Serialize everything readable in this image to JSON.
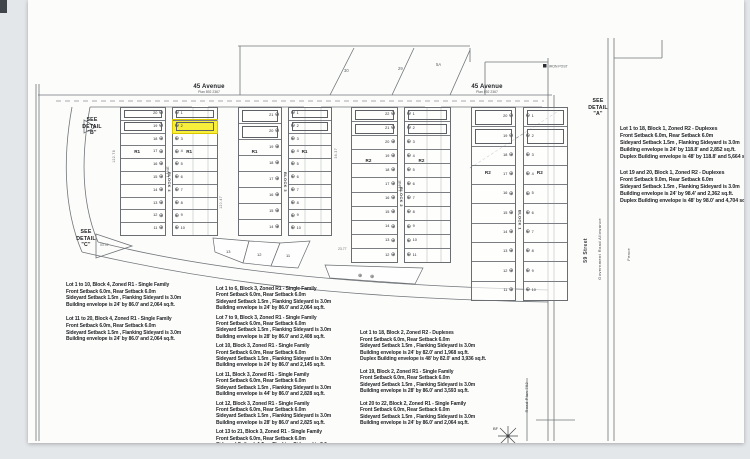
{
  "streets": {
    "avenue_left": {
      "name": "45 Avenue",
      "plan": "Plan 892 2367"
    },
    "avenue_right": {
      "name": "45 Avenue",
      "plan": "Plan 892 2367"
    },
    "street_59": "59 Street",
    "gov_road_allowance": "Government Road Allowance",
    "fence": "Fence",
    "road_plan": "Road Plan 792",
    "lane": "LANE"
  },
  "callouts": {
    "detail_a": "SEE\nDETAIL\n\"A\"",
    "detail_b": "SEE\nDETAIL\n\"B\"",
    "detail_c": "SEE\nDETAIL\n\"C\""
  },
  "markers": {
    "bf": "BF",
    "iron_post": "IRON POST"
  },
  "parcel_numbers": [
    "30",
    "29",
    "5A"
  ],
  "dims": [
    "122.78",
    "120.47",
    "36.37",
    "53.92",
    "23.77"
  ],
  "plat": {
    "marker_glyph": "⊕",
    "highlight_color": "#f7ef3a",
    "angled_lot_numbers": [
      "13",
      "12",
      "11"
    ],
    "groups": [
      {
        "name": "block-4",
        "label": "BLOCK 4",
        "zone": "R1",
        "x": 92,
        "y": 107,
        "w": 98,
        "h": 129,
        "lane_label": true,
        "west": [
          "20",
          "19",
          "18",
          "17",
          "16",
          "15",
          "14",
          "13",
          "12",
          "11"
        ],
        "east": [
          "1",
          "2",
          "3",
          "4",
          "5",
          "6",
          "7",
          "8",
          "9",
          "10"
        ],
        "highlight": {
          "side": "e",
          "index": 1
        }
      },
      {
        "name": "block-3",
        "label": "BLOCK 3",
        "zone": "R1",
        "x": 210,
        "y": 107,
        "w": 94,
        "h": 129,
        "lane_label": false,
        "west": [
          "21",
          "20",
          "19",
          "18",
          "17",
          "16",
          "15",
          "14"
        ],
        "east": [
          "1",
          "2",
          "3",
          "4",
          "5",
          "6",
          "7",
          "8",
          "9",
          "10"
        ]
      },
      {
        "name": "block-2",
        "label": "BLOCK 2",
        "zone": "R2",
        "x": 323,
        "y": 107,
        "w": 100,
        "h": 156,
        "lane_label": true,
        "west": [
          "22",
          "21",
          "20",
          "19",
          "18",
          "17",
          "16",
          "15",
          "14",
          "13",
          "12"
        ],
        "east": [
          "1",
          "2",
          "3",
          "4",
          "5",
          "6",
          "7",
          "8",
          "9",
          "10",
          "11"
        ]
      },
      {
        "name": "block-1",
        "label": "BLOCK 1",
        "zone": "R2",
        "x": 443,
        "y": 107,
        "w": 97,
        "h": 194,
        "lane_label": false,
        "west": [
          "20",
          "19",
          "18",
          "17",
          "16",
          "15",
          "14",
          "13",
          "12",
          "11"
        ],
        "east": [
          "1",
          "2",
          "3",
          "4",
          "5",
          "6",
          "7",
          "8",
          "9",
          "10"
        ]
      }
    ]
  },
  "notes": {
    "columns": [
      {
        "x": 38,
        "y": 282,
        "w": 150,
        "fs": 5,
        "lh": 6.6,
        "gap": 8,
        "blocks": [
          [
            "Lot 1 to 10, Block 4, Zoned R1 - Single Family",
            "Front Setback 6.0m, Rear Setback 6.0m",
            "Sideyard Setback 1.5m , Flanking Sideyard is 3.0m",
            "Building envelope is 24' by 86.0' and 2,064 sq.ft."
          ],
          [
            "Lot 11 to 20, Block 4, Zoned R1 - Single Family",
            "Front Setback 6.0m, Rear Setback 6.0m",
            "Sideyard Setback 1.5m , Flanking Sideyard is 3.0m",
            "Building envelope is 24' by 86.0' and 2,064 sq.ft."
          ]
        ]
      },
      {
        "x": 188,
        "y": 286,
        "w": 142,
        "fs": 5,
        "lh": 6.4,
        "gap": 3,
        "blocks": [
          [
            "Lot 1 to 6, Block 3, Zoned R1 - Single Family",
            "Front Setback 6.0m, Rear Setback 6.0m",
            "Sideyard Setback 1.5m , Flanking Sideyard is 3.0m",
            "Building envelope is 24' by 86.0' and 2,064 sq.ft."
          ],
          [
            "Lot 7 to 9, Block 3, Zoned R1 - Single Family",
            "Front Setback 6.0m, Rear Setback 6.0m",
            "Sideyard Setback 1.5m , Flanking Sideyard is 3.0m",
            "Building envelope is 28' by 86.0' and 2,408 sq.ft."
          ],
          [
            "Lot 10, Block 3, Zoned R1 - Single Family",
            "Front Setback 6.0m, Rear Setback 6.0m",
            "Sideyard Setback 1.5m , Flanking Sideyard is 3.0m",
            "Building envelope is 24' by 86.0' and 2,145 sq.ft."
          ],
          [
            "Lot 11, Block 3, Zoned R1 - Single Family",
            "Front Setback 6.0m, Rear Setback 6.0m",
            "Sideyard Setback 1.5m , Flanking Sideyard is 3.0m",
            "Building envelope is 44' by 86.0' and 2,828 sq.ft."
          ],
          [
            "Lot 12, Block 3, Zoned R1 - Single Family",
            "Front Setback 6.0m, Rear Setback 6.0m",
            "Sideyard Setback 1.5m , Flanking Sideyard is 3.0m",
            "Building envelope is 28' by 86.0' and 2,825 sq.ft."
          ],
          [
            "Lot 13 to 21, Block 3, Zoned R1 - Single Family",
            "Front Setback 6.0m, Rear Setback 6.0m",
            "Sideyard Setback 1.5m , Flanking Sideyard is 3.0m"
          ]
        ]
      },
      {
        "x": 332,
        "y": 330,
        "w": 150,
        "fs": 5,
        "lh": 6.5,
        "gap": 6,
        "blocks": [
          [
            "Lot 1 to 18, Block 2, Zoned R2 - Duplexes",
            "Front Setback 6.0m, Rear Setback 6.0m",
            "Sideyard Setback 1.5m , Flanking Sideyard is 3.0m",
            "Building envelope is 24' by 82.0' and 1,968 sq.ft.",
            "Duplex Building envelope is 48' by 82.0' and 3,936 sq.ft."
          ],
          [
            "Lot 19, Block 2, Zoned R1 - Single Family",
            "Front Setback 6.0m, Rear Setback 6.0m",
            "Sideyard Setback 1.5m , Flanking Sideyard is 3.0m",
            "Building envelope is 28' by 86.0' and 3,593 sq.ft."
          ],
          [
            "Lot 20 to 22, Block 2, Zoned R1 - Single Family",
            "Front Setback 6.0m, Rear Setback 6.0m",
            "Sideyard Setback 1.5m , Flanking Sideyard is 3.0m",
            "Building envelope is 24' by 86.0' and 2,064 sq.ft."
          ]
        ]
      },
      {
        "x": 592,
        "y": 126,
        "w": 158,
        "fs": 5.2,
        "lh": 7,
        "gap": 9,
        "blocks": [
          [
            "Lot 1 to 18, Block 1, Zoned R2 - Duplexes",
            "Front Setback 6.0m, Rear Setback 6.0m",
            "Sideyard Setback 1.5m , Flanking Sideyard is 3.0m",
            "Building envelope is 24' by 118.8' and 2,852 sq.ft.",
            "Duplex Building envelope is 48' by 118.8' and 5,664 sq.ft."
          ],
          [
            "Lot 19 and 20, Block 1, Zoned R2 - Duplexes",
            "Front Setback 9.0m, Rear Setback 6.0m",
            "Sideyard Setback 1.5m , Flanking Sideyard is 3.0m",
            "Building envelope is 24' by 98.4' and 2,362 sq.ft.",
            "Duplex Building envelope is 48' by 98.0' and 4,704 sq.ft."
          ]
        ]
      }
    ]
  }
}
